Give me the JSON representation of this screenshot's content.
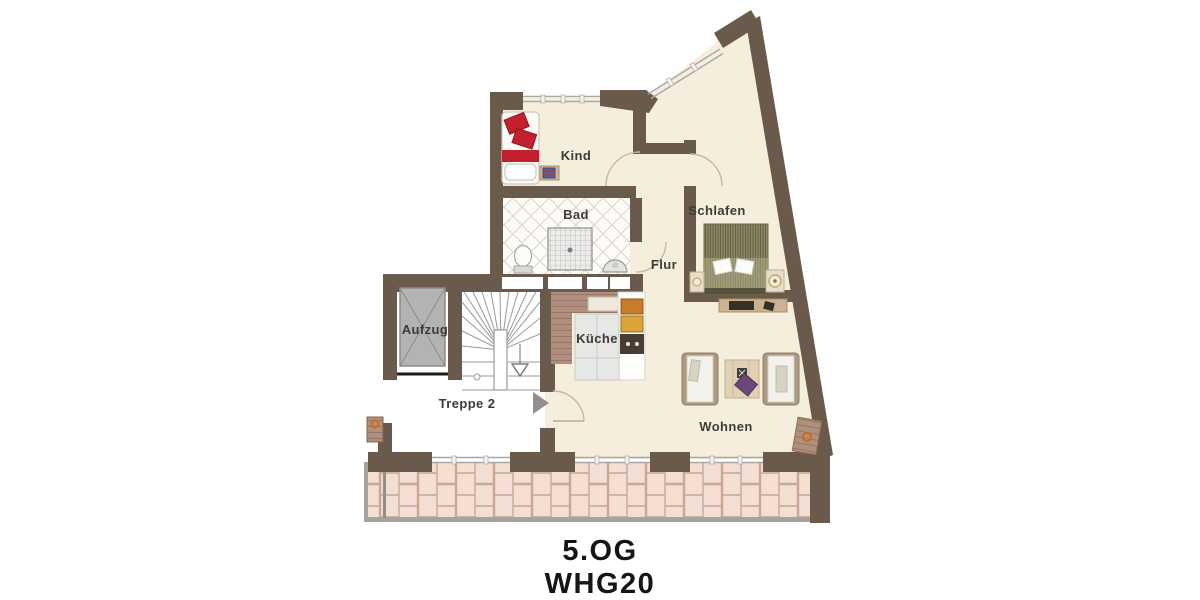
{
  "plan": {
    "floor_label": "5.OG",
    "unit_label": "WHG20",
    "rooms": [
      {
        "id": "kind",
        "label": "Kind"
      },
      {
        "id": "bad",
        "label": "Bad"
      },
      {
        "id": "schlafen",
        "label": "Schlafen"
      },
      {
        "id": "flur",
        "label": "Flur"
      },
      {
        "id": "kueche",
        "label": "Küche"
      },
      {
        "id": "aufzug",
        "label": "Aufzug"
      },
      {
        "id": "treppe",
        "label": "Treppe 2"
      },
      {
        "id": "wohnen",
        "label": "Wohnen"
      }
    ],
    "colors": {
      "wall": "#695a4b",
      "floor": "#f6eedd",
      "terrace_tile": "#f2ded2",
      "terrace_joint": "#c9a795",
      "window_line": "#a8a8a6",
      "label_text": "#3c3c34",
      "title_text": "#151515",
      "accent_red": "#c2202c",
      "bed_olive": "#8a8863",
      "wood": "#b29183",
      "elevator_gray": "#b3b3b3",
      "deco_orange": "#cf6a1c",
      "cushion_purple": "#6a4878"
    },
    "icons": [
      {
        "name": "entrance-arrow"
      },
      {
        "name": "stairs-direction-arrow"
      }
    ]
  }
}
